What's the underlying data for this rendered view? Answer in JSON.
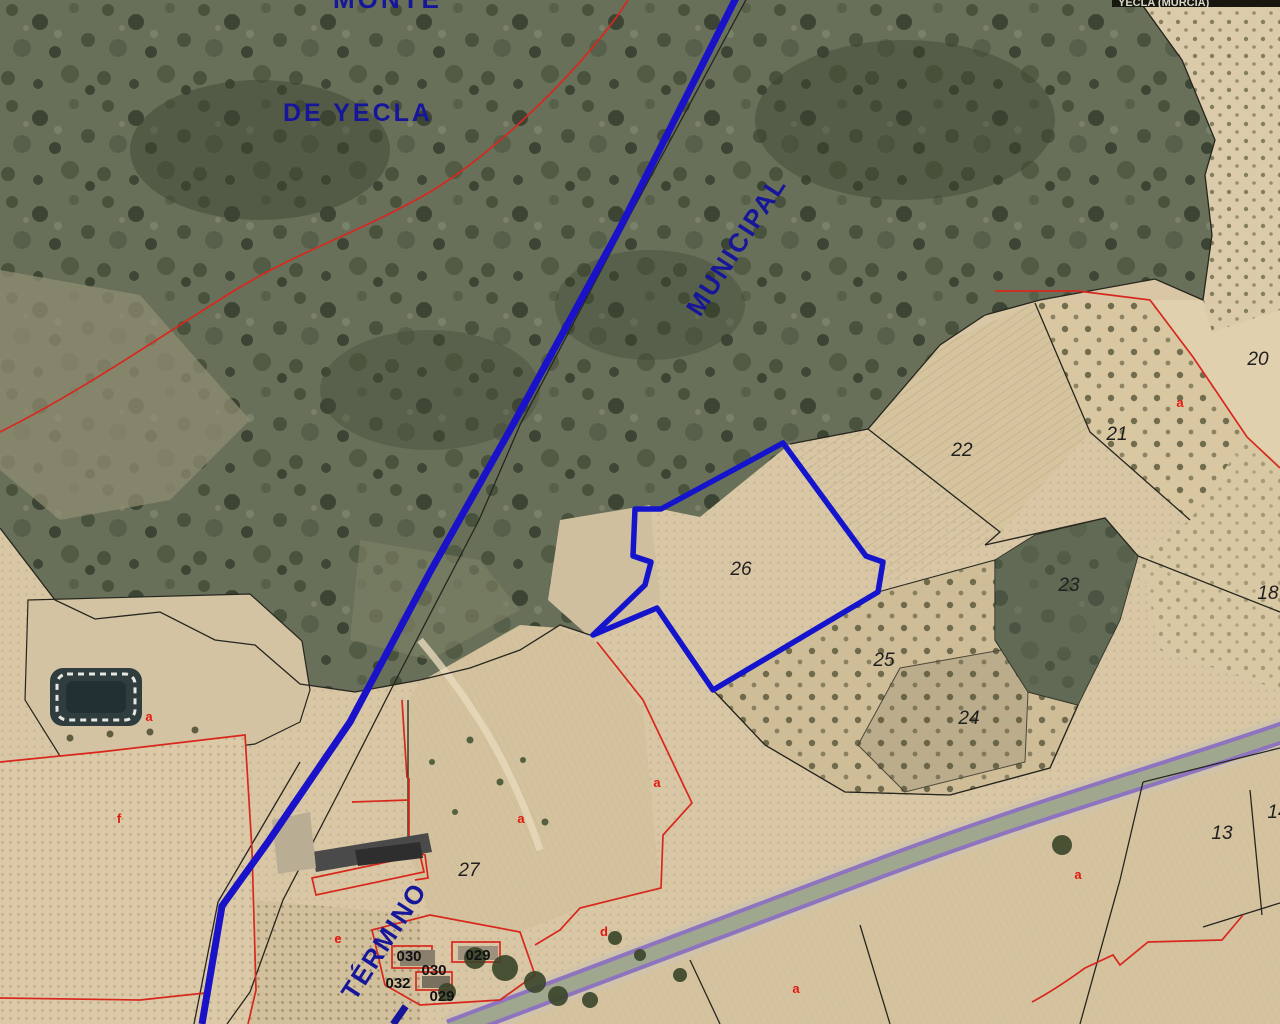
{
  "map": {
    "type": "cadastral-aerial-view",
    "boundary_labels": {
      "monte": "MONTE",
      "de_yecla": "DE YECLA",
      "municipal": "MUNICIPAL",
      "termino": "TÉRMINO"
    },
    "corner_label": "YECLA (MURCIA)",
    "parcel_numbers": [
      "20",
      "21",
      "22",
      "23",
      "24",
      "25",
      "26",
      "27",
      "18",
      "13",
      "14"
    ],
    "construction_codes": [
      "030",
      "029",
      "030",
      "032",
      "029"
    ],
    "subparcel_letters": [
      "a",
      "a",
      "a",
      "a",
      "a",
      "a",
      "d",
      "e",
      "f"
    ],
    "colors": {
      "selected_parcel_outline": "#1414cc",
      "municipal_boundary_line": "#1a12c8",
      "boundary_text": "#16169b",
      "cadastral_parcel_line": "#d8281e",
      "parcel_number_text": "#1f1f1f",
      "road_casing": "#8a6fc0",
      "road_surface": "#a0a78f",
      "scrubland": "#68705a",
      "farmland": "#d8c6a4"
    }
  }
}
